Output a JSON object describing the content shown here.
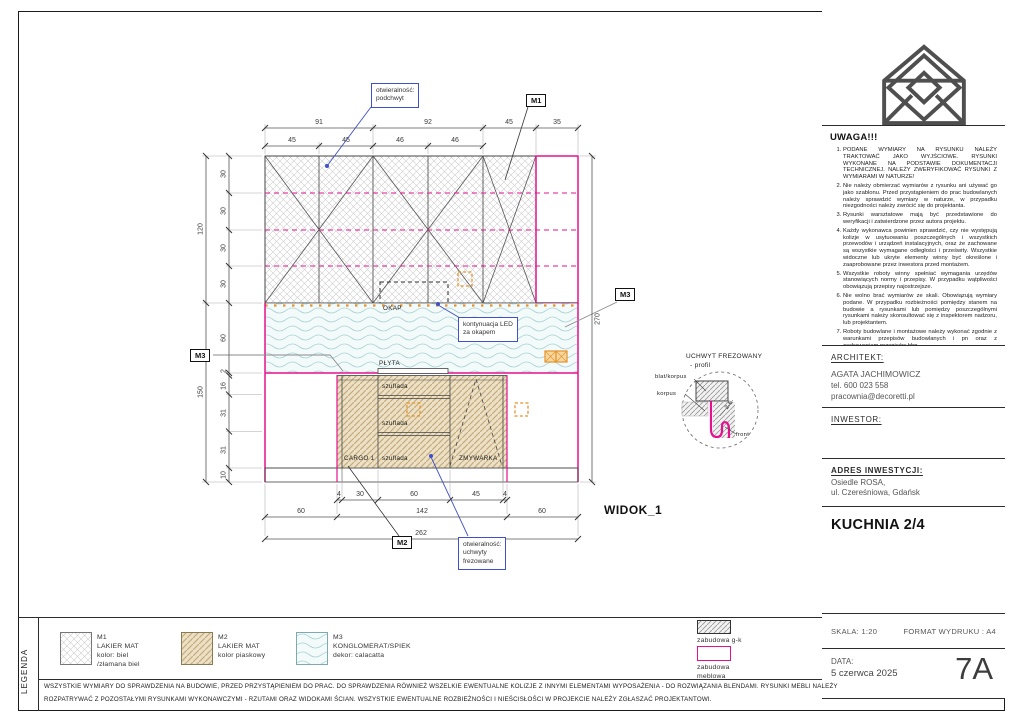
{
  "sheet": {
    "legend_strip_label": "LEGENDA",
    "footer_line1": "WSZYSTKIE WYMIARY DO SPRAWDZENIA NA BUDOWIE, PRZED PRZYSTĄPIENIEM DO PRAC. DO SPRAWDZENIA RÓWNIEŻ WSZELKIE EWENTUALNE KOLIZJE Z INNYMI ELEMENTAMI WYPOSAŻENIA - DO ROZWIĄZANIA BLENDAMI. RYSUNKI MEBLI NALEŻY",
    "footer_line2": "ROZPATRYWAĆ Z POZOSTAŁYMI RYSUNKAMI WYKONAWCZYMI - RZUTAMI ORAZ WIDOKAMI ŚCIAN. WSZYSTKIE EWENTUALNE ROZBIEŻNOŚCI I NIEŚCISŁOŚCI W PROJEKCIE NALEŻY ZGŁASZAĆ PROJEKTANTOWI."
  },
  "notes_panel": {
    "title": "UWAGA!!!",
    "items": [
      "PODANE WYMIARY NA RYSUNKU NALEŻY TRAKTOWAĆ JAKO WYJŚCIOWE. RYSUNKI WYKONANE NA PODSTAWIE DOKUMENTACJI TECHNICZNEJ. NALEŻY ZWERYFIKOWAĆ RYSUNKI Z WYMIARAMI W NATURZE!",
      "Nie należy obmierzać wymiarów z rysunku ani używać go jako szablonu. Przed przystąpieniem do prac budowlanych należy sprawdzić wymiary w naturze, w przypadku niezgodności należy zwrócić się do projektanta.",
      "Rysunki warsztatowe mają być przedstawione do weryfikacji i zatwierdzone przez autora projektu.",
      "Każdy wykonawca powinien sprawdzić, czy nie występują kolizje w usytuowaniu poszczególnych i wszystkich przewodów i urządzeń instalacyjnych, oraz że zachowane są wszystkie wymagane odległości i prześwity. Wszystkie widoczne lub ukryte elementy winny być określone i zaaprobowane przez inwestora przed montażem.",
      "Wszystkie roboty winny spełniać wymagania urzędów stanowiących normy i przepisy. W przypadku wątpliwości obowiązują przepisy najostrzejsze.",
      "Nie wolno brać wymiarów ze skali. Obowiązują wymiary podane. W przypadku rozbieżności pomiędzy stanem na budowie a rysunkami lub pomiędzy poszczególnymi rysunkami należy skonsultować się z inspektorem nadzoru, lub projektantem.",
      "Roboty budowlane i montażowe należy wykonać zgodnie z warunkami przepisów budowlanych i pn oraz z zachowaniem przepisów bhp.",
      "Wszystkie wymiary stolarki i ślusarki drzwiowej i okiennej, wewnętrznej i zewnętrznej należy sprawdzić w naturze przed realizacją."
    ]
  },
  "architect": {
    "heading": "ARCHITEKT:",
    "name": "AGATA JACHIMOWICZ",
    "phone": "tel. 600 023 558",
    "email": "pracownia@decoretti.pl"
  },
  "investor": {
    "heading": "INWESTOR:"
  },
  "address": {
    "heading": "ADRES INWESTYCJI:",
    "line1": "Osiedle ROSA,",
    "line2": "ul. Czereśniowa, Gdańsk"
  },
  "titleblock": {
    "title": "KUCHNIA 2/4",
    "scale_label": "SKALA: 1:20",
    "format_label": "FORMAT WYDRUKU : A4",
    "date_heading": "DATA:",
    "date": "5 czerwca 2025",
    "sheet_no": "7A"
  },
  "drawing": {
    "view_label": "WIDOK_1",
    "labels": {
      "okap": "OKAP",
      "plyta": "PŁYTA",
      "cargo": "CARGO 1",
      "szuflada": "szuflada",
      "zmywarka": "ZMYWARKA"
    },
    "markers": {
      "m1": "M1",
      "m2": "M2",
      "m3": "M3"
    },
    "callouts": {
      "podchwyt": {
        "l1": "otwieralność:",
        "l2": "podchwyt"
      },
      "led": {
        "l1": "kontynuacja LED",
        "l2": "za okapem"
      },
      "uchwyty": {
        "l1": "otwieralność:",
        "l2": "uchwyty",
        "l3": "frezowane"
      }
    },
    "detail": {
      "title": "UCHWYT FREZOWANY",
      "subtitle": "- profil",
      "label_blat": "blat/korpus",
      "label_korpus": "korpus",
      "label_front": "front",
      "dim": "2.6"
    },
    "dims": {
      "top1": [
        "91",
        "92",
        "45",
        "35"
      ],
      "top2": [
        "45",
        "45",
        "46",
        "46"
      ],
      "left_outer": [
        "120",
        "150"
      ],
      "left_inner": [
        "30",
        "30",
        "30",
        "30",
        "60",
        "2",
        "16",
        "31",
        "31",
        "10"
      ],
      "right": [
        "270"
      ],
      "bottom1": [
        "4",
        "30",
        "60",
        "45",
        "4"
      ],
      "bottom2": [
        "60",
        "142",
        "60"
      ],
      "bottom3": [
        "262"
      ]
    }
  },
  "legend": {
    "materials": [
      {
        "code": "M1",
        "line1": "LAKIER MAT",
        "line2": "kolor: biel",
        "line3": "/złamana biel"
      },
      {
        "code": "M2",
        "line1": "LAKIER MAT",
        "line2": "kolor piaskowy",
        "line3": ""
      },
      {
        "code": "M3",
        "line1": "KONGLOMERAT/SPIEK",
        "line2": "dekor: calacatta",
        "line3": ""
      }
    ],
    "zones": [
      {
        "label1": "zabudowa g-k",
        "label2": ""
      },
      {
        "label1": "zabudowa",
        "label2": "meblowa"
      }
    ]
  },
  "colors": {
    "magenta": "#e6108e",
    "blue": "#4050c8",
    "orange": "#e8922a",
    "hatch_gray": "#c9c9c9",
    "sand": "#c7ad7e",
    "teal": "#abd2d6"
  }
}
